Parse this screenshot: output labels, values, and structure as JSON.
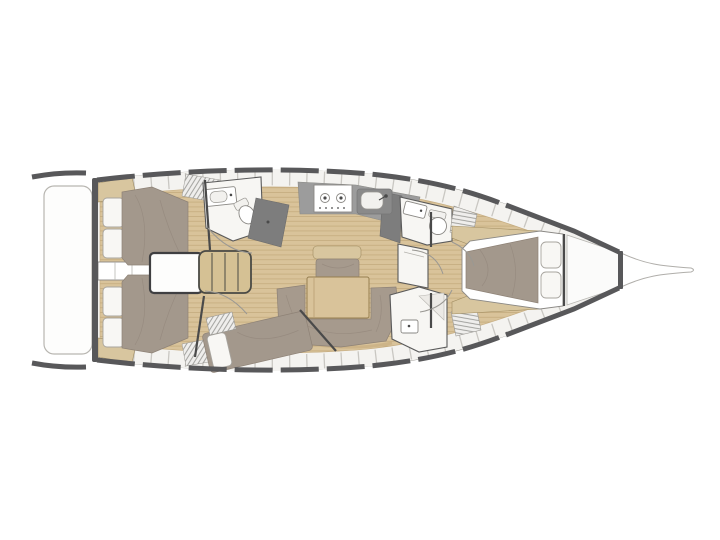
{
  "diagram": {
    "kind": "yacht-interior-floor-plan",
    "view": "top-down, bow pointing right",
    "visible_text": ""
  },
  "colors": {
    "background": "#ffffff",
    "hull_outline": "#9a9893",
    "hull_dark": "#58585a",
    "deck": "#f1f0ed",
    "deck_band": "#f4f3f0",
    "seam": "#c9c7c2",
    "wood": "#d9c39a",
    "wood_line": "#c5ab7e",
    "wood_trim": "#cdb488",
    "tan": "#d8c69f",
    "tan_stroke": "#a08c60",
    "taupe": "#a3988c",
    "taupe_dark": "#8e8276",
    "sofa": "#a69a8d",
    "pillow": "#f8f7f4",
    "pillow_stroke": "#a7a49e",
    "room": "#f7f6f3",
    "room_stroke": "#5a5a5a",
    "counter": "#9c9c9c",
    "counter_dark": "#7d7d7d",
    "fixture_stroke": "#8a8884",
    "box_stroke": "#3f3f41",
    "step": "#d5c194",
    "step_stroke": "#4a4a45",
    "table": "#d9c39a",
    "table_stroke": "#967f50",
    "platform": "#fdfdfc",
    "platform_stroke": "#b8b6b1",
    "slat_bg": "#efeeec",
    "slat_line": "#9a9a96",
    "arc": "#9a9893",
    "wall": "#4a4a4a"
  },
  "areas": [
    {
      "name": "swim-platform",
      "features": [
        "fold-down transom platform"
      ]
    },
    {
      "name": "aft-cabin-port",
      "features": [
        "double-berth",
        "two-pillows",
        "hull-locker-grating"
      ]
    },
    {
      "name": "aft-cabin-starboard",
      "features": [
        "double-berth",
        "two-pillows",
        "hull-locker-grating"
      ]
    },
    {
      "name": "companionway",
      "features": [
        "engine-box",
        "four-tread-steps",
        "door-arcs"
      ]
    },
    {
      "name": "aft-head-port",
      "features": [
        "sink",
        "toilet",
        "shower-pan"
      ]
    },
    {
      "name": "galley",
      "features": [
        "two-burner-stove",
        "sink",
        "worktop",
        "fridge-counter"
      ]
    },
    {
      "name": "saloon",
      "features": [
        "u-settee",
        "dining-table",
        "forward-settee",
        "teak-sole"
      ]
    },
    {
      "name": "mid-cabin-starboard",
      "features": [
        "angled-double-berth",
        "pillow",
        "slatted-bench"
      ]
    },
    {
      "name": "head-starboard",
      "features": [
        "seat",
        "sink",
        "teak-grating"
      ]
    },
    {
      "name": "forward-head",
      "features": [
        "sink",
        "toilet",
        "teak-grating"
      ]
    },
    {
      "name": "forward-cabin",
      "features": [
        "island-double-berth",
        "two-pillows",
        "side-shelves"
      ]
    },
    {
      "name": "bow",
      "features": [
        "anchor-locker",
        "bowsprit"
      ]
    }
  ]
}
